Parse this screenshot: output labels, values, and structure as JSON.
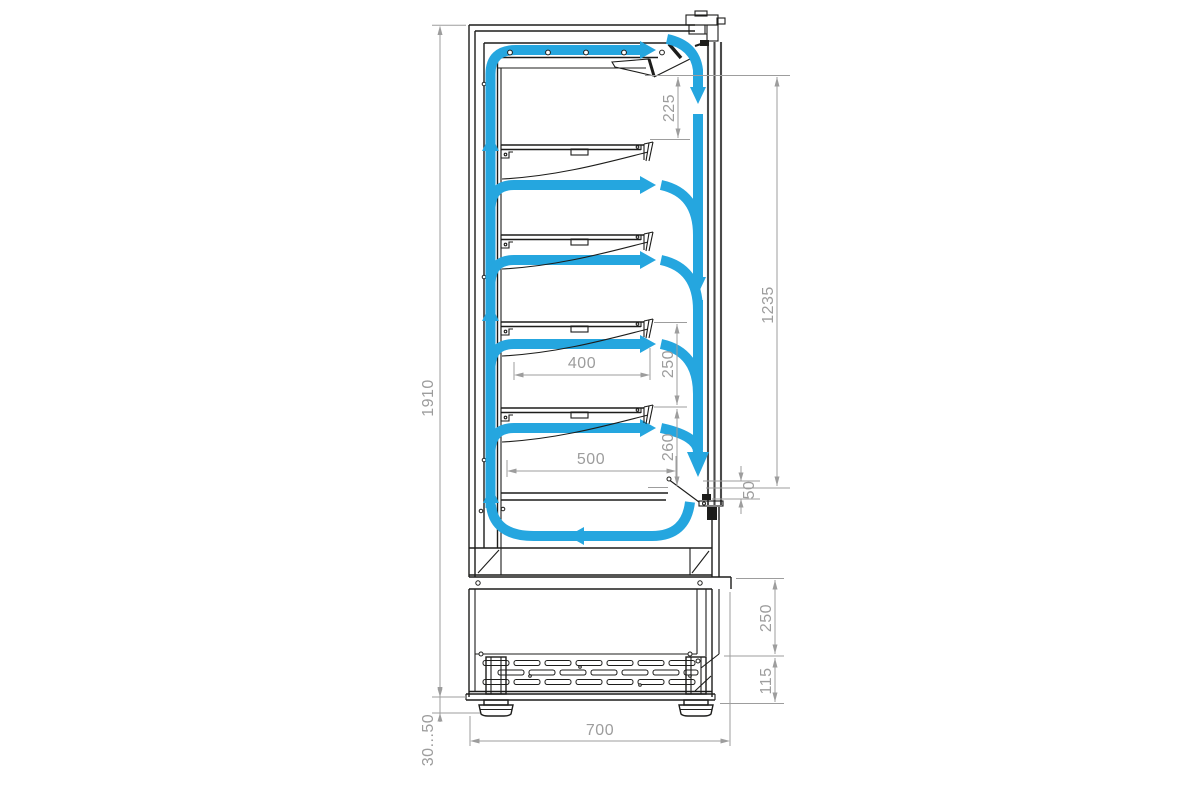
{
  "diagram": {
    "description": "Refrigerated display cabinet side cross-section with air flow circulation arrows and dimensions",
    "colors": {
      "flow_blue": "#25a6df",
      "drawing_line": "#1d1d1b",
      "dimension_gray": "#9d9d9d",
      "background": "#ffffff"
    },
    "dimensions": {
      "overall_height": "1910",
      "top_air_gap": "225",
      "display_opening_height": "1235",
      "shelf_spacing": "250",
      "shelf_depth": "400",
      "lower_shelf_clearance": "260",
      "interior_depth": "500",
      "air_return_gap": "50",
      "base_section_height": "250",
      "grille_height": "115",
      "base_depth": "700",
      "feet_adjust_range": "30...50"
    }
  }
}
